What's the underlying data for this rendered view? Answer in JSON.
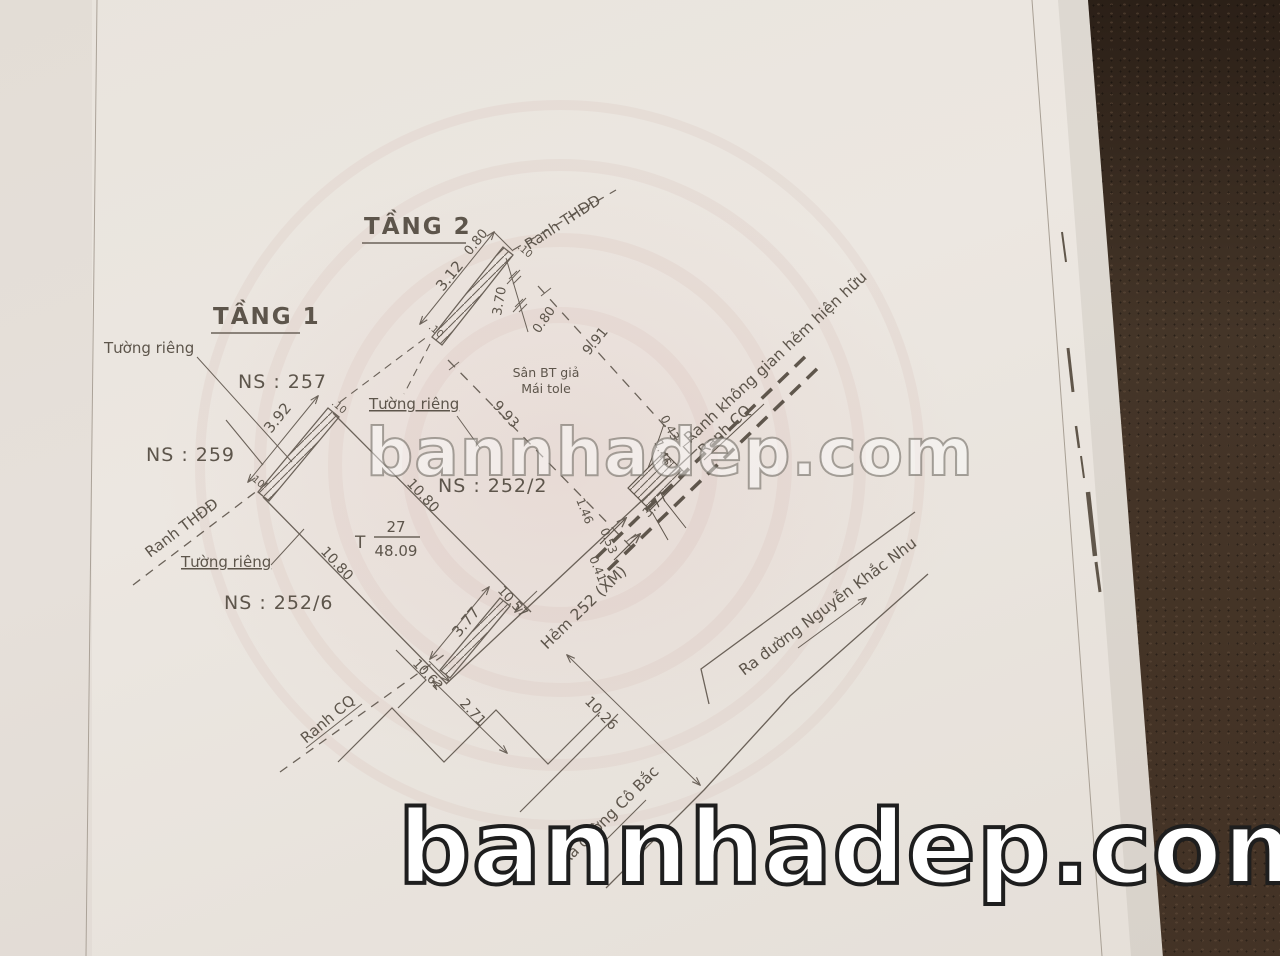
{
  "colors": {
    "paper": "#eae5df",
    "ink": "#6b6259",
    "carpet": "#443528",
    "watermark_bottom_outline": "#1e1e1e"
  },
  "watermarks": {
    "center": "bannhadep.com",
    "bottom": "bannhadep.com"
  },
  "headings": {
    "tang1": "TẦNG 1",
    "tang2": "TẦNG 2"
  },
  "parcels": {
    "ns257": "NS : 257",
    "ns259": "NS : 259",
    "ns252_2": "NS : 252/2",
    "ns252_6": "NS : 252/6"
  },
  "parcel_ref": {
    "prefix": "T",
    "lot": "27",
    "area": "48.09"
  },
  "labels": {
    "tuong_rieng": "Tường riêng",
    "ranh_thdd": "Ranh THĐĐ",
    "ranh_cq": "Ranh CQ",
    "ranh_khong_gian": "Ranh không gian hẻm hiện hữu",
    "san_bt": "Sân BT giả",
    "mai_tole": "Mái tole",
    "hem": "Hẻm 252 (XM)",
    "ra_nkn": "Ra đường Nguyễn Khắc Nhu",
    "ra_cb": "Ra đường Cô Bắc"
  },
  "dims": {
    "d312": "3.12",
    "d080a": "0.80",
    "d370": "3.70",
    "d080b": "0.80",
    "d991": "9.91",
    "d392": "3.92",
    "d993": "9.93",
    "d1080a": "10.80",
    "d1080b": "10.80",
    "d043": "0.43",
    "d146a": "1.46",
    "d146b": "1.46",
    "d053": "0.53",
    "d041": "0.41",
    "d377a": "3.77",
    "d377b": "3.77",
    "d1057": "10.57",
    "d1062": "10.62",
    "d271": "2.71",
    "d1026": "10.26",
    "t10a": ".10",
    "t10b": ".10",
    "t10c": ".10",
    "t10d": ".10"
  }
}
